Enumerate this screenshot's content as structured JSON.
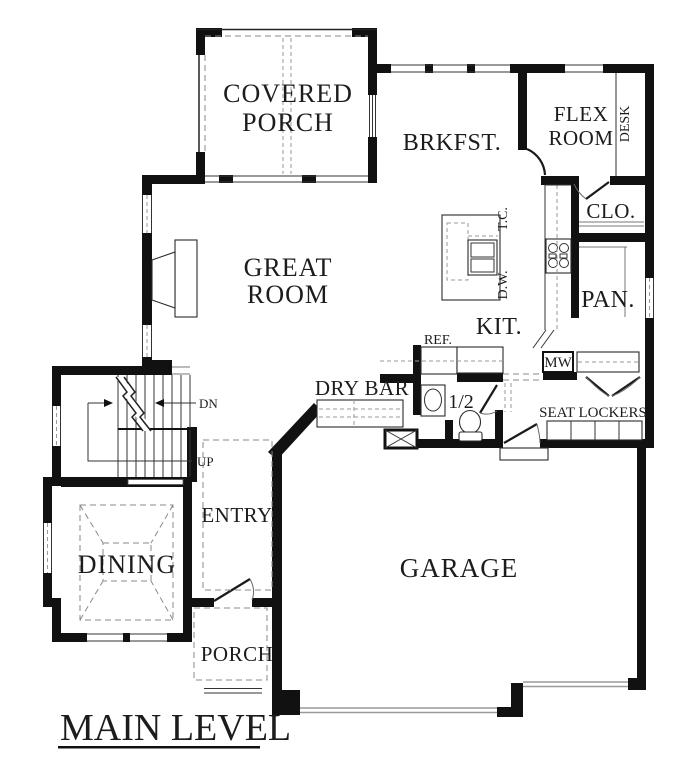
{
  "title": "MAIN LEVEL",
  "rooms": {
    "covered_porch_l1": "COVERED",
    "covered_porch_l2": "PORCH",
    "brkfst": "BRKFST.",
    "flex_l1": "FLEX",
    "flex_l2": "ROOM",
    "desk": "DESK",
    "closet_upper": "CLO.",
    "great_l1": "GREAT",
    "great_l2": "ROOM",
    "kitchen": "KIT.",
    "pantry": "PAN.",
    "dry_bar": "DRY BAR",
    "half_bath": "1/2",
    "seat_lockers": "SEAT LOCKERS",
    "entry": "ENTRY",
    "dining": "DINING",
    "garage": "GARAGE",
    "porch": "PORCH"
  },
  "appliances": {
    "trash_compactor": "T.C.",
    "dishwasher": "D.W.",
    "refrigerator": "REF.",
    "microwave": "MW"
  },
  "stairs": {
    "down": "DN",
    "up": "UP"
  },
  "colors": {
    "wall": "#111111",
    "background": "#ffffff",
    "thin_line": "#333333",
    "dashed_line": "#8a8a8a"
  }
}
